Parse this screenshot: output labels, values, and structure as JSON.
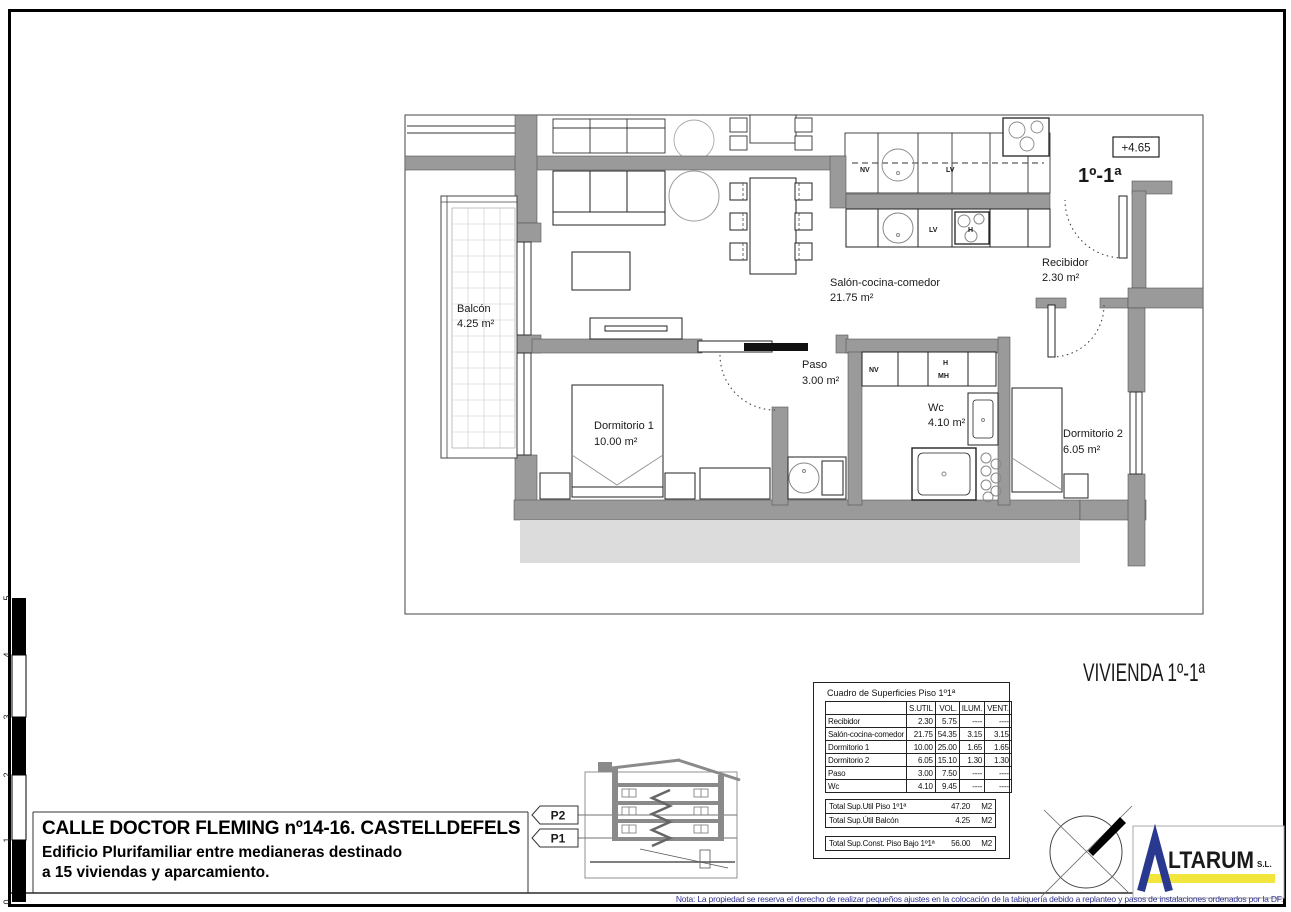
{
  "sheet": {
    "note": "Nota: La propiedad se reserva el derecho de realizar pequeños ajustes en la colocación de la tabiquería debido a replanteo y pasos de instalaciones ordenados por la DF.",
    "scale_ticks": [
      "5",
      "4",
      "3",
      "2",
      "1",
      "0"
    ]
  },
  "title_block": {
    "address": "CALLE DOCTOR FLEMING nº14-16. CASTELLDEFELS",
    "description_line1": "Edificio Plurifamiliar entre medianeras destinado",
    "description_line2": "a 15 viviendas y aparcamiento."
  },
  "plan": {
    "unit_label": "1º-1ª",
    "level_label": "+4.65",
    "rooms": [
      {
        "name": "Balcón",
        "area": "4.25 m²"
      },
      {
        "name": "Salón-cocina-comedor",
        "area": "21.75 m²"
      },
      {
        "name": "Recibidor",
        "area": "2.30 m²"
      },
      {
        "name": "Paso",
        "area": "3.00 m²"
      },
      {
        "name": "Dormitorio 1",
        "area": "10.00 m²"
      },
      {
        "name": "Wc",
        "area": "4.10 m²"
      },
      {
        "name": "Dormitorio 2",
        "area": "6.05 m²"
      }
    ],
    "appliances": {
      "nv": "NV",
      "lv": "LV",
      "h": "H",
      "mh": "MH"
    }
  },
  "vivienda_label": "VIVIENDA 1º-1ª",
  "floor_markers": {
    "p2": "P2",
    "p1": "P1"
  },
  "surface_table": {
    "title": "Cuadro de Superficies Piso 1º1ª",
    "columns": [
      "S.UTIL",
      "VOL.",
      "ILUM.",
      "VENT."
    ],
    "rows": [
      {
        "name": "Recibidor",
        "sutil": "2.30",
        "vol": "5.75",
        "ilum": "----",
        "vent": "----"
      },
      {
        "name": "Salón-cocina-comedor",
        "sutil": "21.75",
        "vol": "54.35",
        "ilum": "3.15",
        "vent": "3.15"
      },
      {
        "name": "Dormitorio 1",
        "sutil": "10.00",
        "vol": "25.00",
        "ilum": "1.65",
        "vent": "1.65"
      },
      {
        "name": "Dormitorio 2",
        "sutil": "6.05",
        "vol": "15.10",
        "ilum": "1.30",
        "vent": "1.30"
      },
      {
        "name": "Paso",
        "sutil": "3.00",
        "vol": "7.50",
        "ilum": "----",
        "vent": "----"
      },
      {
        "name": "Wc",
        "sutil": "4.10",
        "vol": "9.45",
        "ilum": "----",
        "vent": "----"
      }
    ],
    "totals": [
      {
        "label": "Total Sup.Util Piso 1º1ª",
        "value": "47.20",
        "unit": "M2"
      },
      {
        "label": "Total Sup.Útil Balcón",
        "value": "4.25",
        "unit": "M2"
      },
      {
        "label": "Total Sup.Const. Piso Bajo 1º1ª",
        "value": "56.00",
        "unit": "M2"
      }
    ]
  },
  "logo": {
    "name": "LTARUM",
    "suffix": "S.L."
  },
  "colors": {
    "wall_grey": "#9a9a9a",
    "section_below_grey": "#dcdcdc",
    "logo_blue": "#2a3990",
    "logo_yellow": "#f2e63d",
    "logo_red": "#cc2222",
    "note_blue": "#2e2e8f"
  }
}
